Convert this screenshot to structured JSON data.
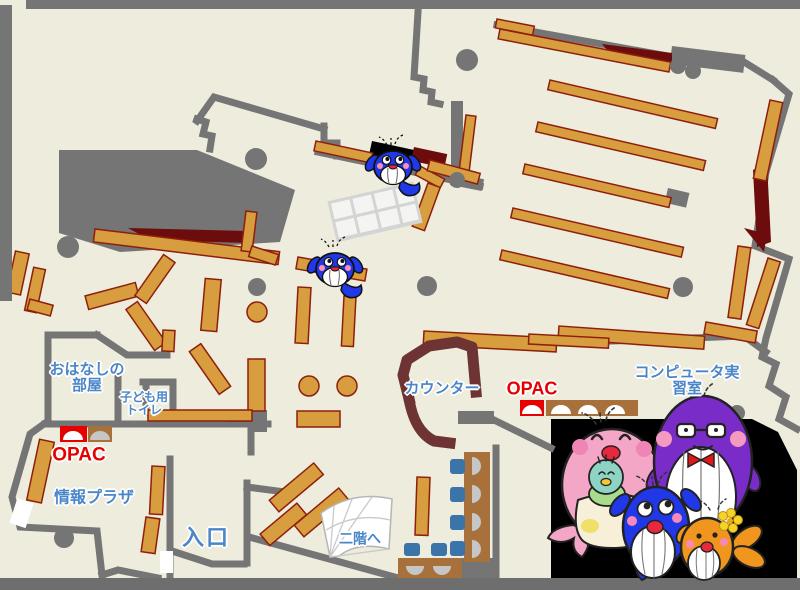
{
  "map": {
    "title": "library-first-floor-map",
    "labels": {
      "storytelling_room": "おはなしの\n部屋",
      "kids_toilet": "子ども用\nトイレ",
      "opac_left": "OPAC",
      "opac_right": "OPAC",
      "info_plaza": "情報プラザ",
      "entrance": "入口",
      "counter": "カウンター",
      "computer_room": "コンピュータ実習室",
      "to_second_floor": "二階へ"
    },
    "colors": {
      "floor": "#edecdd",
      "wall_gray": "#757575",
      "shelf_orange": "#d79d3e",
      "shelf_border": "#8e1f0c",
      "dark_red_area": "#6d0c0c",
      "counter_maroon": "#6e3434",
      "table_brown": "#a8713c",
      "chair_blue": "#3b74a8",
      "label_blue": "#4a86c8",
      "label_red": "#e60000",
      "photo_background": "#000000",
      "mascot_blue": "#2038e8",
      "mascot_pink": "#f4a6c6",
      "mascot_purple": "#7a2cc8",
      "mascot_orange": "#f0951d",
      "mascot_teal": "#8ed4c4"
    },
    "icons": {
      "map_whale_1": "whale-mascot-icon",
      "map_whale_2": "whale-mascot-icon",
      "family_photo": "whale-family-illustration",
      "stairs": "stairs-fan-icon",
      "opac_terminal": "opac-terminal-icon"
    }
  }
}
